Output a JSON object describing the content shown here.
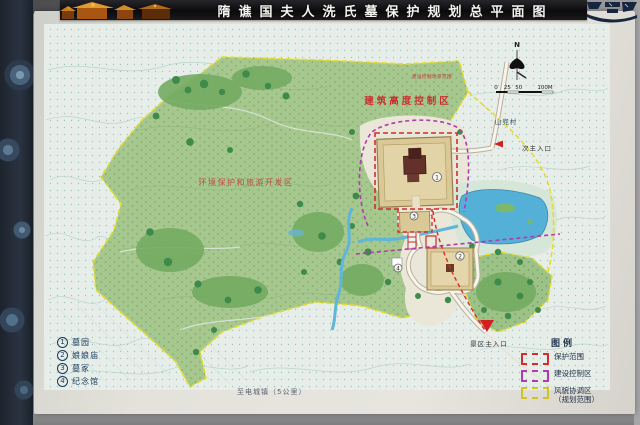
{
  "banner": {
    "title": "隋谯国夫人洗氏墓保护规划总平面图"
  },
  "map": {
    "north_label": "N",
    "scale_ticks": [
      "0",
      "25",
      "50",
      "100M"
    ],
    "labels": {
      "control_small": "建设控制地带范围",
      "height_control": "建筑高度控制区",
      "env_tourism": "环境保护和旅游开发区",
      "village": "山兜村",
      "secondary_entrance": "次主入口",
      "main_entrance": "景区主入口",
      "to_town": "至电城镇（5公里）"
    },
    "markers": [
      {
        "num": "1"
      },
      {
        "num": "2"
      },
      {
        "num": "3"
      },
      {
        "num": "4"
      }
    ],
    "numbered_legend": [
      {
        "num": "1",
        "label": "墓园"
      },
      {
        "num": "2",
        "label": "娘娘庙"
      },
      {
        "num": "3",
        "label": "墓冢"
      },
      {
        "num": "4",
        "label": "纪念馆"
      }
    ],
    "legend": {
      "title": "图例",
      "items": [
        {
          "label": "保护范围",
          "color": "#d22c2c"
        },
        {
          "label": "建设控制区",
          "color": "#b03ab0"
        },
        {
          "label": "风貌协调区",
          "label2": "（规划范围）",
          "color": "#cfc322"
        }
      ]
    }
  },
  "colors": {
    "planning_green": "#a6c78e",
    "water_blue": "#58b2d8",
    "protection_red": "#d22c2c",
    "control_purple": "#b03ab0",
    "coordination_yellow": "#e2da32",
    "banner_black": "#0b0b0d"
  }
}
